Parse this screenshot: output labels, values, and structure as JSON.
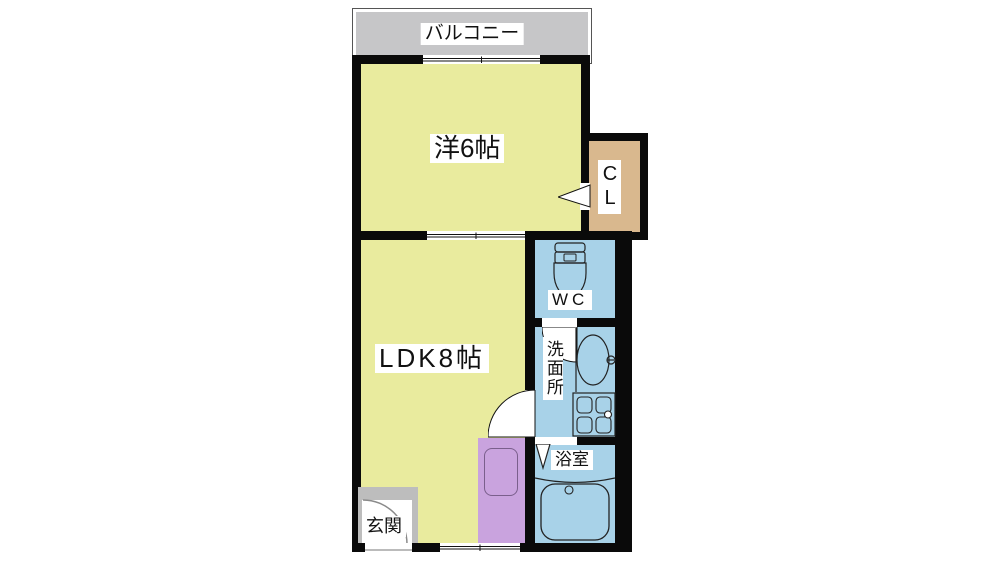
{
  "plan": {
    "balcony_label": "バルコニー",
    "western_room_label": "洋6帖",
    "closet_label": "CL",
    "ldk_label": "LDK8帖",
    "toilet_label": "WC",
    "washroom_label": "洗面所",
    "bathroom_label": "浴室",
    "entrance_label": "玄関"
  },
  "icons": {
    "toilet": "toilet-icon",
    "sink": "sink-icon",
    "washing_machine": "washing-machine-icon",
    "bathtub": "bathtub-icon",
    "kitchen_counter": "kitchen-sink-icon",
    "door_swings": "door-swing-icon",
    "folding_door": "folding-door-icon",
    "windows": "window-icon"
  },
  "colors": {
    "room_yellow": "#e9eb9e",
    "wet_blue": "#a8d2e8",
    "closet_tan": "#d9b88e",
    "kitchen_purple": "#c9a3de",
    "balcony_gray": "#c6c6c8",
    "entrance_gray": "#bdbdbd",
    "wall_black": "#0a0a0a"
  }
}
